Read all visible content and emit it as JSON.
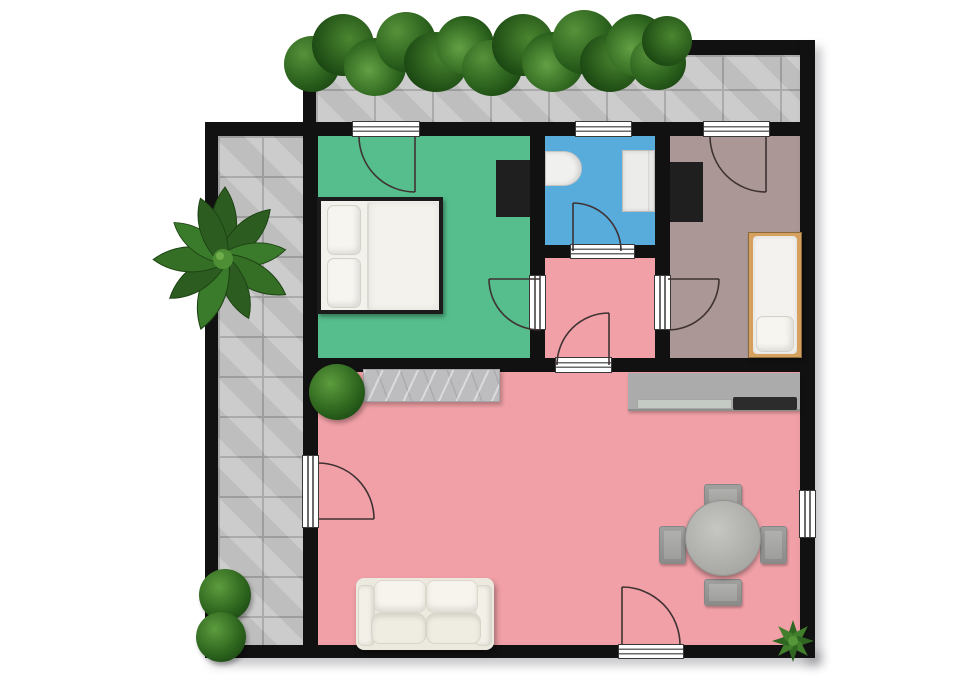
{
  "meta": {
    "title": "apartment-floor-plan-top-view",
    "type": "floor-plan",
    "visible_text": "none"
  },
  "palette": {
    "wall": "#111111",
    "bedroom_green": "#55be8c",
    "bathroom_blue": "#57acdc",
    "living_pink": "#f0a0a6",
    "bedroom_mauve": "#ab9896",
    "terrace_tile": "#c8c8c8",
    "terrace_grout": "#a5a5a5",
    "counter_gray": "#ababab",
    "stove_dark": "#2c2c2c",
    "marble": "#bdbdc0",
    "wood": "#d6a05f",
    "white_furniture": "#f3f1ec",
    "sofa_cream": "#ece9df",
    "door_arc": "#3f3232",
    "wardrobe_dark": "#1f1f1f"
  },
  "rooms": [
    {
      "name": "bedroom-master",
      "floor_color_ref": "bedroom_green"
    },
    {
      "name": "bathroom",
      "floor_color_ref": "bathroom_blue"
    },
    {
      "name": "bedroom-single",
      "floor_color_ref": "bedroom_mauve"
    },
    {
      "name": "hallway",
      "floor_color_ref": "living_pink"
    },
    {
      "name": "living-room-with-kitchen",
      "floor_color_ref": "living_pink"
    },
    {
      "name": "terrace-left",
      "floor_color_ref": "terrace_tile"
    },
    {
      "name": "balcony-top",
      "floor_color_ref": "terrace_tile"
    }
  ],
  "furniture": [
    {
      "name": "double-bed",
      "room": "bedroom-master"
    },
    {
      "name": "wardrobe",
      "room": "bedroom-master"
    },
    {
      "name": "toilet",
      "room": "bathroom"
    },
    {
      "name": "shower-unit",
      "room": "bathroom"
    },
    {
      "name": "wardrobe",
      "room": "bedroom-single"
    },
    {
      "name": "single-bed",
      "room": "bedroom-single"
    },
    {
      "name": "kitchen-counter-with-sink-and-stove",
      "room": "living-room-with-kitchen"
    },
    {
      "name": "marble-sideboard",
      "room": "living-room-with-kitchen"
    },
    {
      "name": "round-dining-table-with-four-chairs",
      "room": "living-room-with-kitchen"
    },
    {
      "name": "two-seat-sofa",
      "room": "living-room-with-kitchen"
    }
  ],
  "openings": {
    "doors": 8,
    "windows": 4
  },
  "plants": [
    "hedge-row-top",
    "large-leaf-plant-terrace",
    "round-bush-living-room",
    "round-bush-terrace-1",
    "round-bush-terrace-2",
    "corner-plant-bottom-right"
  ]
}
